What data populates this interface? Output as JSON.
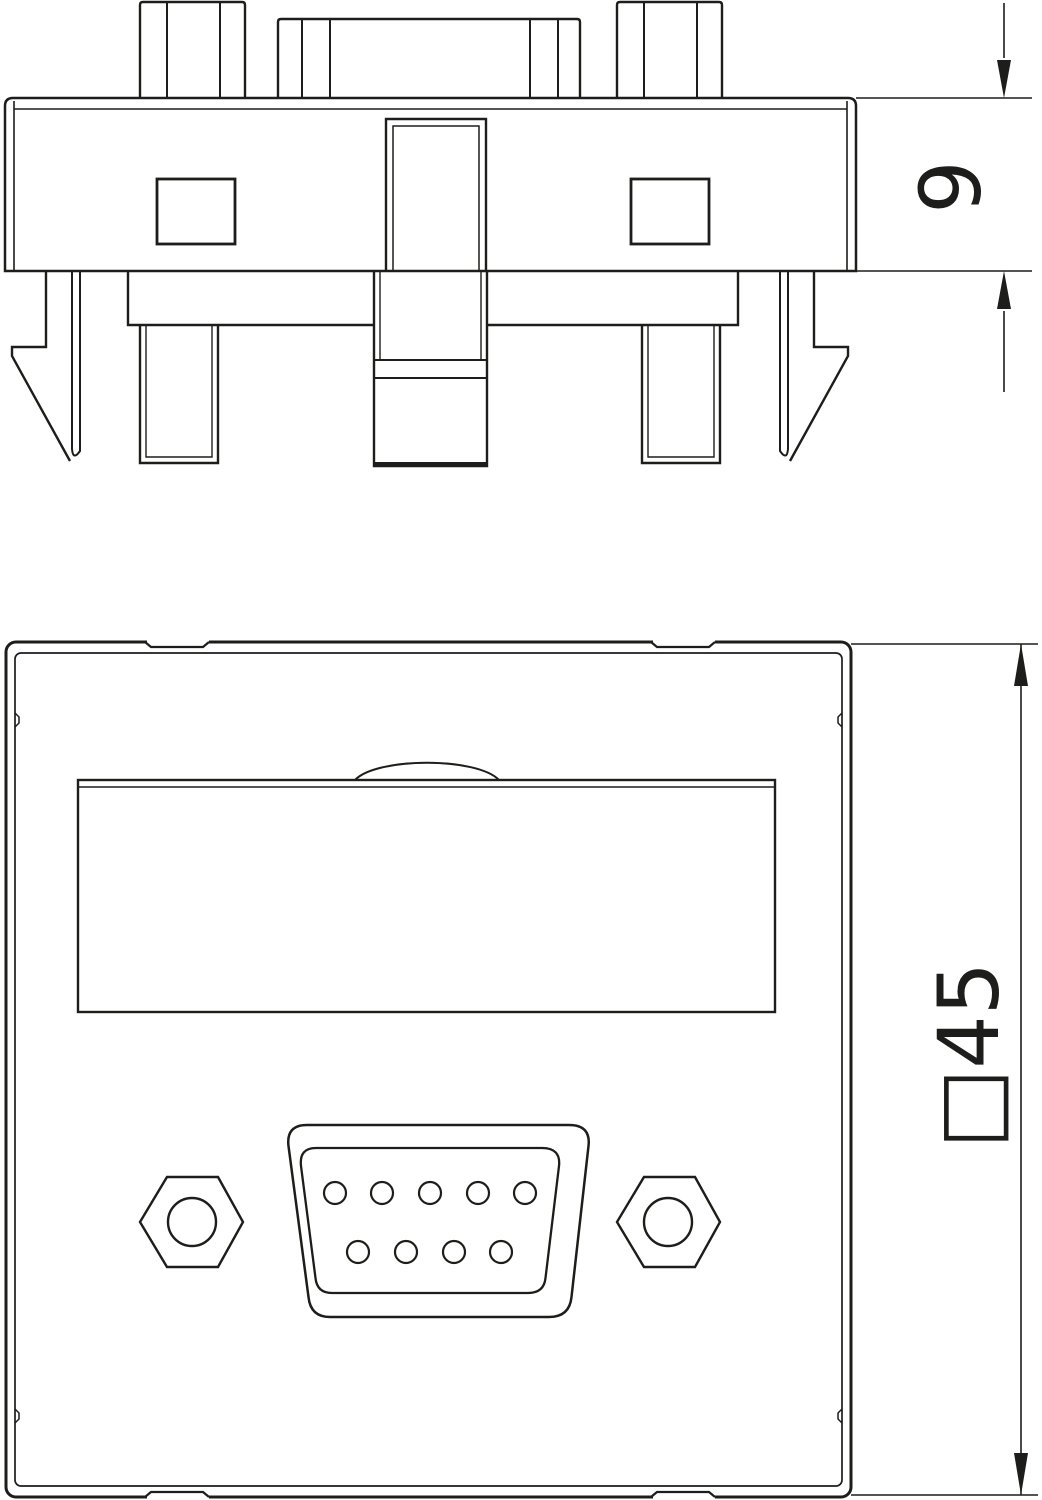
{
  "drawing": {
    "background": "#ffffff",
    "line_color": "#1d1d1b",
    "views": {
      "side": {
        "name": "side-elevation-view",
        "dimension": {
          "label": "9"
        }
      },
      "front": {
        "name": "front-face-view",
        "dimension": {
          "label": "□45",
          "value": "45",
          "prefix": "□"
        },
        "connector": {
          "shape": "d-sub-9",
          "pins_top_row": 5,
          "pins_bottom_row": 4,
          "pin_total": 9
        }
      }
    }
  }
}
